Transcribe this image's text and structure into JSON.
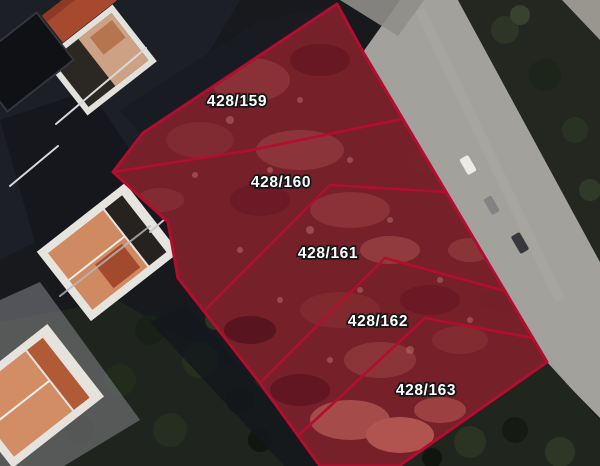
{
  "map": {
    "view_type": "satellite-cadastral-overlay",
    "parcels": [
      {
        "label": "428/159"
      },
      {
        "label": "428/160"
      },
      {
        "label": "428/161"
      },
      {
        "label": "428/162"
      },
      {
        "label": "428/163"
      }
    ],
    "colors": {
      "parcel_outline": "#b30d2f",
      "parcel_fill_tint": "rgba(140,8,38,0.30)",
      "label_text": "#ffffff",
      "label_halo": "#161616",
      "road": "#a3a19c"
    }
  }
}
